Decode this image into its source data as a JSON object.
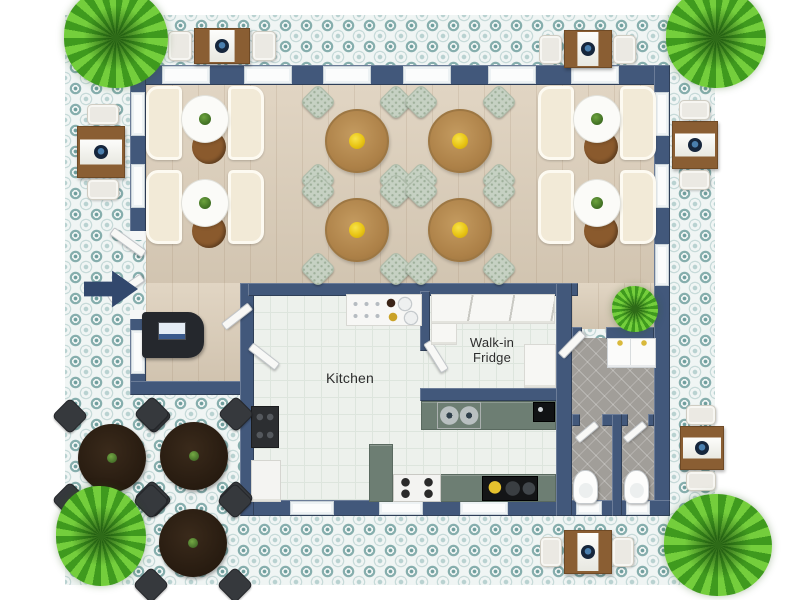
{
  "palette": {
    "wall": "#42587b",
    "patio_bg": "#f0f5f4",
    "patio_tile": "#86aead",
    "wood": "#dcceb9",
    "kitchen_tile": "#edf1ec",
    "bath_tile": "#a19e99",
    "counter": "#6d7e73",
    "booth": "#f2ead7",
    "table_wood": "#ad8148",
    "chair": "#c6d1c3",
    "centerpiece": "#e8c413",
    "outdoor_table": "#8a5e33",
    "dark_table": "#271b10",
    "dark_chair": "#36393d",
    "plant_dark": "#3f9a1e",
    "plant_light": "#74ce3c",
    "arrow": "#32486d"
  },
  "rooms": {
    "kitchen": {
      "label": "Kitchen"
    },
    "walk_in_fridge": {
      "line1": "Walk-in",
      "line2": "Fridge"
    }
  },
  "floorplan": {
    "items": [
      {
        "t": "win",
        "n": "window",
        "x": 162,
        "y": 66,
        "w": 48,
        "h": 18,
        "i": true
      },
      {
        "t": "win",
        "n": "window",
        "x": 244,
        "y": 66,
        "w": 48,
        "h": 18,
        "i": true
      },
      {
        "t": "win",
        "n": "window",
        "x": 323,
        "y": 66,
        "w": 48,
        "h": 18,
        "i": true
      },
      {
        "t": "win",
        "n": "window",
        "x": 403,
        "y": 66,
        "w": 48,
        "h": 18,
        "i": true
      },
      {
        "t": "win",
        "n": "window",
        "x": 488,
        "y": 66,
        "w": 48,
        "h": 18,
        "i": true
      },
      {
        "t": "win",
        "n": "window",
        "x": 571,
        "y": 66,
        "w": 48,
        "h": 18,
        "i": true
      },
      {
        "t": "win",
        "n": "window",
        "x": 131,
        "y": 92,
        "w": 14,
        "h": 44,
        "i": true
      },
      {
        "t": "win",
        "n": "window",
        "x": 131,
        "y": 164,
        "w": 14,
        "h": 44,
        "i": true
      },
      {
        "t": "win",
        "n": "window",
        "x": 131,
        "y": 330,
        "w": 14,
        "h": 44,
        "i": true
      },
      {
        "t": "win",
        "n": "window",
        "x": 655,
        "y": 92,
        "w": 14,
        "h": 44,
        "i": true
      },
      {
        "t": "win",
        "n": "window",
        "x": 655,
        "y": 164,
        "w": 14,
        "h": 44,
        "i": true
      },
      {
        "t": "win",
        "n": "window",
        "x": 655,
        "y": 244,
        "w": 14,
        "h": 42,
        "i": true
      },
      {
        "t": "win",
        "n": "window",
        "x": 290,
        "y": 501,
        "w": 44,
        "h": 14,
        "i": true
      },
      {
        "t": "win",
        "n": "window",
        "x": 379,
        "y": 501,
        "w": 44,
        "h": 14,
        "i": true
      },
      {
        "t": "win",
        "n": "window",
        "x": 460,
        "y": 501,
        "w": 48,
        "h": 14,
        "i": true
      },
      {
        "t": "win",
        "n": "window",
        "x": 576,
        "y": 501,
        "w": 26,
        "h": 14,
        "i": true
      },
      {
        "t": "win",
        "n": "window",
        "x": 626,
        "y": 501,
        "w": 24,
        "h": 14,
        "i": true
      },
      {
        "t": "jamb",
        "n": "door-jamb",
        "x": 130,
        "y": 231,
        "w": 16,
        "h": 9,
        "i": false
      },
      {
        "t": "jamb",
        "n": "door-jamb",
        "x": 130,
        "y": 310,
        "w": 16,
        "h": 9,
        "i": false
      },
      {
        "t": "door",
        "n": "entrance-door-leaf",
        "x": 108,
        "y": 238,
        "w": 40,
        "h": 9,
        "r": 36,
        "i": true
      },
      {
        "t": "door",
        "n": "entrance-door-leaf",
        "x": 106,
        "y": 284,
        "w": 40,
        "h": 9,
        "r": -34,
        "i": true
      },
      {
        "t": "door",
        "n": "service-door-leaf",
        "x": 220,
        "y": 312,
        "w": 34,
        "h": 9,
        "r": -38,
        "i": true
      },
      {
        "t": "door",
        "n": "service-door-leaf",
        "x": 247,
        "y": 352,
        "w": 34,
        "h": 9,
        "r": 38,
        "i": true
      },
      {
        "t": "door",
        "n": "walk-in-fridge-door",
        "x": 419,
        "y": 352,
        "w": 34,
        "h": 9,
        "r": 58,
        "i": true
      },
      {
        "t": "door",
        "n": "bathroom-hall-door",
        "x": 556,
        "y": 340,
        "w": 32,
        "h": 9,
        "r": -46,
        "i": true
      },
      {
        "t": "door",
        "n": "stall-door",
        "x": 574,
        "y": 428,
        "w": 26,
        "h": 8,
        "r": -40,
        "i": true
      },
      {
        "t": "door",
        "n": "stall-door",
        "x": 622,
        "y": 428,
        "w": 26,
        "h": 8,
        "r": -40,
        "i": true
      },
      {
        "t": "booth-set",
        "n": "booth-seating",
        "x": 146,
        "y": 86,
        "w": 118,
        "h": 76,
        "i": true
      },
      {
        "t": "booth-set",
        "n": "booth-seating",
        "x": 146,
        "y": 170,
        "w": 118,
        "h": 76,
        "i": true
      },
      {
        "t": "booth-set",
        "n": "booth-seating",
        "x": 538,
        "y": 86,
        "w": 118,
        "h": 76,
        "i": true
      },
      {
        "t": "booth-set",
        "n": "booth-seating",
        "x": 538,
        "y": 170,
        "w": 118,
        "h": 76,
        "i": true
      },
      {
        "t": "dining-set",
        "n": "dining-table-set",
        "x": 305,
        "y": 89,
        "w": 104,
        "h": 104,
        "i": true
      },
      {
        "t": "dining-set",
        "n": "dining-table-set",
        "x": 408,
        "y": 89,
        "w": 104,
        "h": 104,
        "i": true
      },
      {
        "t": "dining-set",
        "n": "dining-table-set",
        "x": 305,
        "y": 178,
        "w": 104,
        "h": 104,
        "i": true
      },
      {
        "t": "dining-set",
        "n": "dining-table-set",
        "x": 408,
        "y": 178,
        "w": 104,
        "h": 104,
        "i": true
      },
      {
        "t": "host-desk",
        "n": "host-stand",
        "x": 142,
        "y": 312,
        "w": 62,
        "h": 46,
        "i": true
      },
      {
        "t": "svc-counter",
        "n": "service-counter",
        "x": 346,
        "y": 294,
        "w": 76,
        "h": 32,
        "i": true
      },
      {
        "t": "range",
        "n": "range-cooktop",
        "x": 251,
        "y": 406,
        "w": 28,
        "h": 42,
        "i": true
      },
      {
        "t": "cabinet",
        "n": "kitchen-cabinet",
        "x": 251,
        "y": 460,
        "w": 30,
        "h": 42,
        "i": true
      },
      {
        "t": "counter",
        "n": "kitchen-island",
        "x": 369,
        "y": 444,
        "w": 24,
        "h": 58,
        "i": true
      },
      {
        "t": "counter",
        "n": "kitchen-counter",
        "x": 392,
        "y": 474,
        "w": 164,
        "h": 28,
        "i": true
      },
      {
        "t": "stove",
        "n": "gas-stove",
        "x": 393,
        "y": 474,
        "w": 48,
        "h": 28,
        "i": true
      },
      {
        "t": "cooktop",
        "n": "induction-cooktop",
        "x": 482,
        "y": 476,
        "w": 56,
        "h": 25,
        "i": true
      },
      {
        "t": "counter",
        "n": "prep-counter",
        "x": 421,
        "y": 401,
        "w": 135,
        "h": 29,
        "i": true
      },
      {
        "t": "sink2",
        "n": "double-sink",
        "x": 437,
        "y": 402,
        "w": 44,
        "h": 27,
        "i": true
      },
      {
        "t": "coffee",
        "n": "coffee-machine",
        "x": 533,
        "y": 402,
        "w": 22,
        "h": 20,
        "i": true
      },
      {
        "t": "shelf",
        "n": "fridge-shelf",
        "v": "divided",
        "x": 431,
        "y": 294,
        "w": 124,
        "h": 30,
        "i": true
      },
      {
        "t": "shelf",
        "n": "fridge-shelf",
        "x": 431,
        "y": 323,
        "w": 26,
        "h": 22,
        "i": true
      },
      {
        "t": "shelf",
        "n": "fridge-shelf",
        "x": 524,
        "y": 344,
        "w": 32,
        "h": 44,
        "i": true
      },
      {
        "t": "vanity",
        "n": "vanity-double-sink",
        "x": 607,
        "y": 338,
        "w": 49,
        "h": 30,
        "i": true
      },
      {
        "t": "toilet",
        "n": "toilet",
        "x": 573,
        "y": 470,
        "w": 25,
        "h": 34,
        "i": true
      },
      {
        "t": "toilet",
        "n": "toilet",
        "x": 624,
        "y": 470,
        "w": 25,
        "h": 34,
        "i": true
      },
      {
        "t": "sq-table",
        "n": "patio-table",
        "v": "v",
        "x": 194,
        "y": 28,
        "w": 56,
        "h": 36,
        "i": true
      },
      {
        "t": "out-chair",
        "n": "patio-chair",
        "x": 168,
        "y": 31,
        "w": 24,
        "h": 30,
        "i": true
      },
      {
        "t": "out-chair",
        "n": "patio-chair",
        "x": 252,
        "y": 31,
        "w": 24,
        "h": 30,
        "i": true
      },
      {
        "t": "sq-table",
        "n": "patio-table",
        "v": "v",
        "x": 564,
        "y": 30,
        "w": 48,
        "h": 38,
        "i": true
      },
      {
        "t": "out-chair",
        "n": "patio-chair",
        "x": 539,
        "y": 35,
        "w": 23,
        "h": 29,
        "i": true
      },
      {
        "t": "out-chair",
        "n": "patio-chair",
        "x": 613,
        "y": 35,
        "w": 23,
        "h": 29,
        "i": true
      },
      {
        "t": "sq-table",
        "n": "patio-table",
        "v": "h",
        "x": 77,
        "y": 126,
        "w": 48,
        "h": 52,
        "i": true
      },
      {
        "t": "out-chair",
        "n": "patio-chair",
        "x": 87,
        "y": 104,
        "w": 32,
        "h": 21,
        "i": true
      },
      {
        "t": "out-chair",
        "n": "patio-chair",
        "x": 87,
        "y": 179,
        "w": 32,
        "h": 21,
        "i": true
      },
      {
        "t": "sq-table",
        "n": "patio-table",
        "v": "h",
        "x": 672,
        "y": 121,
        "w": 46,
        "h": 48,
        "i": true
      },
      {
        "t": "out-chair",
        "n": "patio-chair",
        "x": 679,
        "y": 100,
        "w": 31,
        "h": 20,
        "i": true
      },
      {
        "t": "out-chair",
        "n": "patio-chair",
        "x": 679,
        "y": 170,
        "w": 31,
        "h": 20,
        "i": true
      },
      {
        "t": "sq-table",
        "n": "patio-table",
        "v": "h",
        "x": 680,
        "y": 426,
        "w": 44,
        "h": 44,
        "i": true
      },
      {
        "t": "out-chair",
        "n": "patio-chair",
        "x": 686,
        "y": 405,
        "w": 30,
        "h": 20,
        "i": true
      },
      {
        "t": "out-chair",
        "n": "patio-chair",
        "x": 686,
        "y": 471,
        "w": 30,
        "h": 20,
        "i": true
      },
      {
        "t": "sq-table",
        "n": "patio-table",
        "v": "v",
        "x": 564,
        "y": 530,
        "w": 48,
        "h": 44,
        "i": true
      },
      {
        "t": "out-chair",
        "n": "patio-chair",
        "x": 540,
        "y": 537,
        "w": 22,
        "h": 30,
        "i": true
      },
      {
        "t": "out-chair",
        "n": "patio-chair",
        "x": 612,
        "y": 537,
        "w": 22,
        "h": 30,
        "i": true
      },
      {
        "t": "dark-set",
        "n": "outdoor-dining-set",
        "x": 57,
        "y": 403,
        "w": 110,
        "h": 110,
        "i": true
      },
      {
        "t": "dark-set",
        "n": "outdoor-dining-set",
        "x": 139,
        "y": 401,
        "w": 110,
        "h": 110,
        "i": true
      },
      {
        "t": "dark-set",
        "n": "outdoor-dining-set",
        "x": 138,
        "y": 488,
        "w": 110,
        "h": 110,
        "i": true
      },
      {
        "t": "arrow",
        "n": "entrance-arrow",
        "x": 84,
        "y": 266,
        "w": 54,
        "h": 46,
        "i": false
      },
      {
        "t": "plant",
        "n": "plant",
        "x": 64,
        "y": -12,
        "w": 104,
        "h": 100,
        "i": true
      },
      {
        "t": "plant",
        "n": "plant",
        "x": 666,
        "y": -12,
        "w": 100,
        "h": 100,
        "i": true
      },
      {
        "t": "plant",
        "n": "plant",
        "x": 56,
        "y": 486,
        "w": 90,
        "h": 100,
        "i": true
      },
      {
        "t": "plant",
        "n": "plant",
        "x": 664,
        "y": 494,
        "w": 108,
        "h": 102,
        "i": true
      },
      {
        "t": "plant",
        "n": "indoor-plant",
        "x": 612,
        "y": 286,
        "w": 46,
        "h": 46,
        "i": true
      }
    ]
  }
}
